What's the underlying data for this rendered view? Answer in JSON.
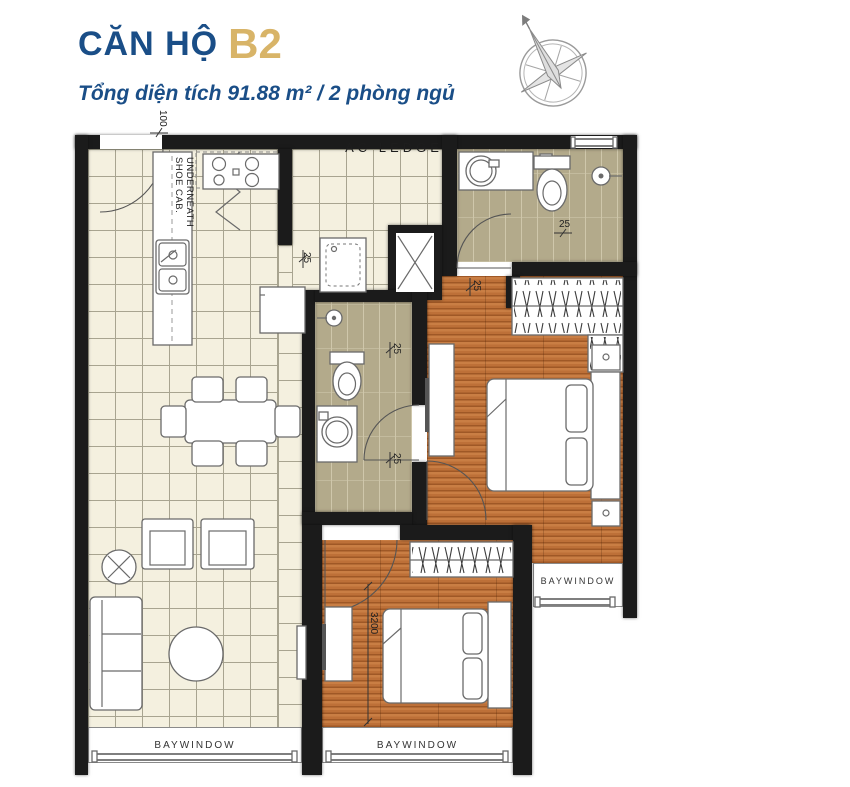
{
  "header": {
    "title": "CĂN HỘ",
    "unit": "B2",
    "subtitle": "Tổng diện tích 91.88 m²  /  2 phòng ngủ"
  },
  "plan": {
    "labels": {
      "ac_ledge": "AC LEDGE",
      "underneath": "UNDERNEATH",
      "shoe_cab": "SHOE CAB.",
      "baywindow_left": "BAYWINDOW",
      "baywindow_middle": "BAYWINDOW",
      "baywindow_right": "BAYWINDOW"
    },
    "dimensions": {
      "entry_top": "100",
      "kitchen": "25",
      "master_bath": "25",
      "hall_pocket": "25",
      "bath2_upper": "25",
      "bath2_lower": "25",
      "bedroom2_width": "3200"
    },
    "icons": {
      "compass": "compass-rose"
    }
  },
  "colors": {
    "title_blue": "#1a4e87",
    "accent_gold": "#d8b468",
    "wall": "#1b1b1b",
    "tile_cream": "#f4f0df",
    "tile_olive": "#b3aa8b",
    "wood": "#bd7038"
  }
}
